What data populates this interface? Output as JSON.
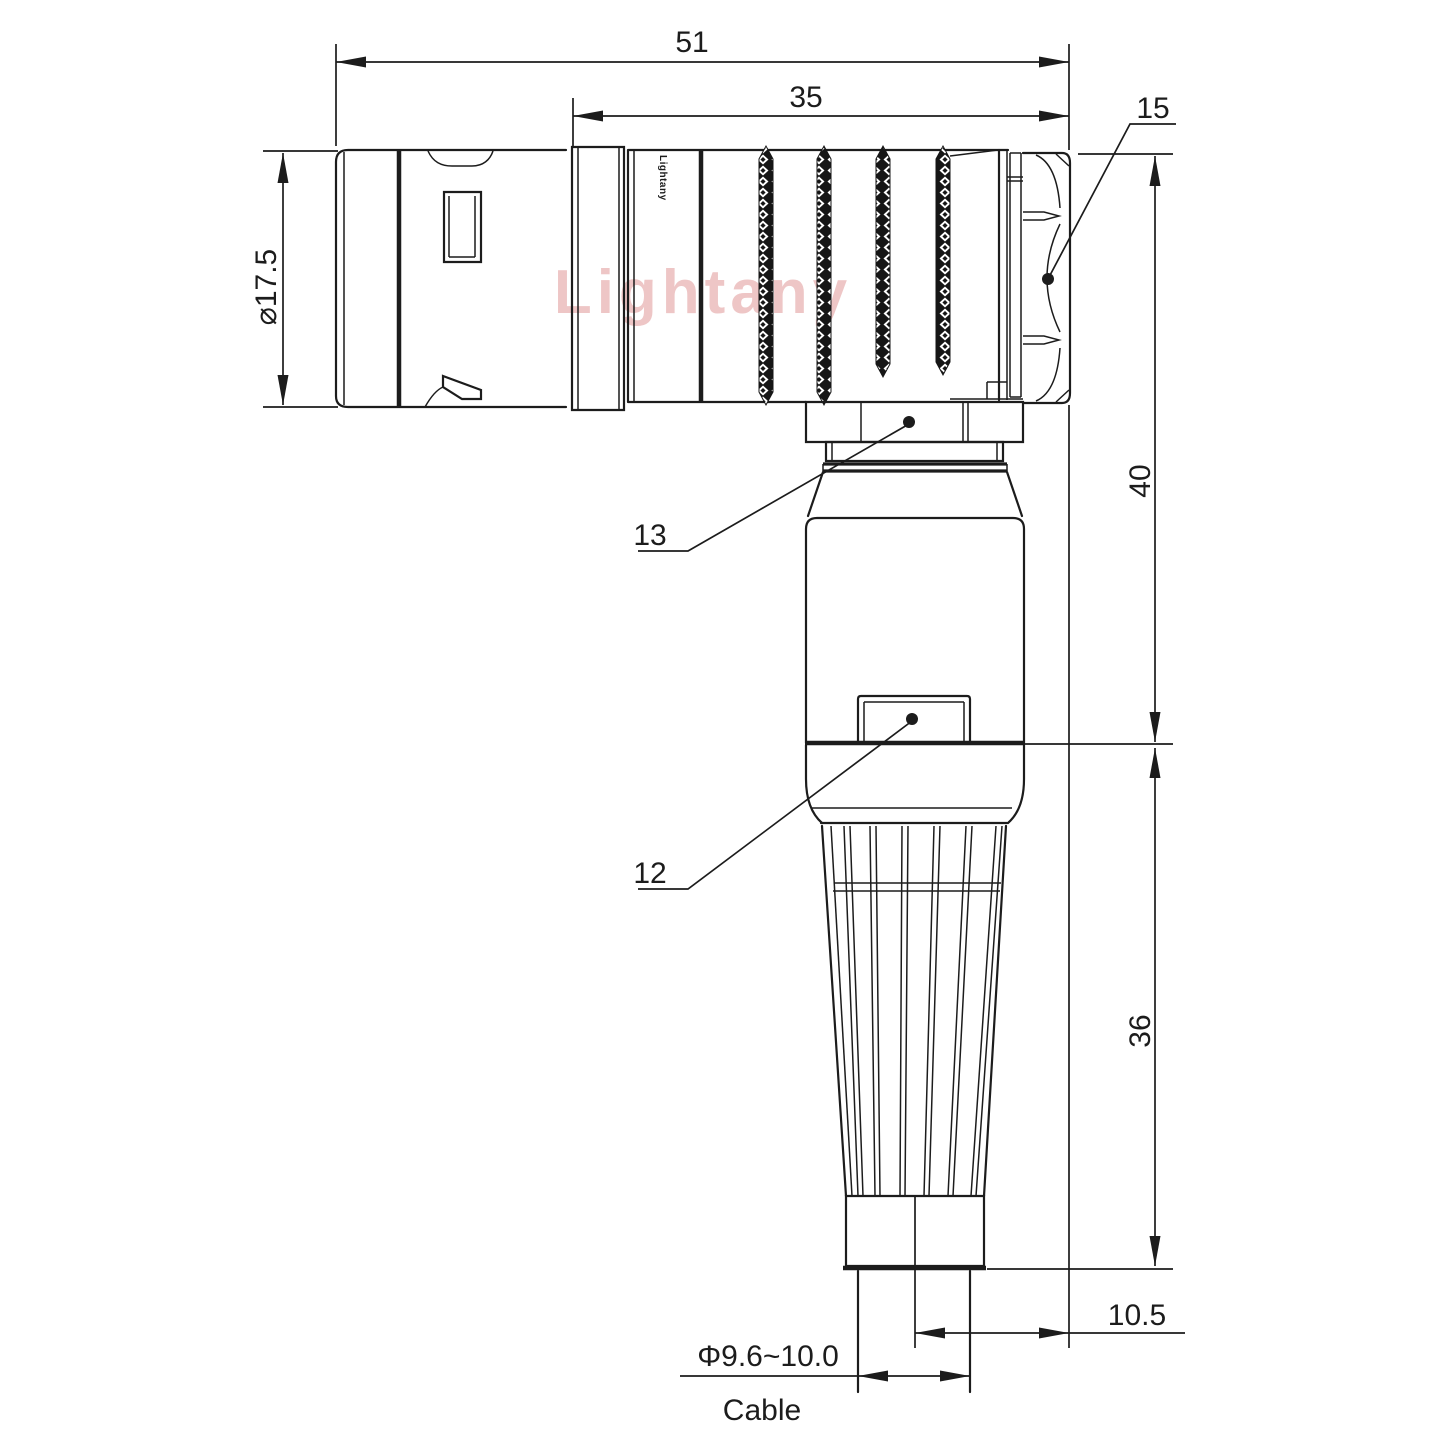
{
  "title": "Right-angle circular connector technical drawing",
  "watermark": "Lightany",
  "brand_marking": "Lightany",
  "dims": {
    "overall_length": "51",
    "body_length": "35",
    "hex_nut_ref": "15",
    "front_diameter": "⌀17.5",
    "upper_height": "40",
    "lower_height": "36",
    "cable_axis_offset": "10.5",
    "cable_diameter": "Φ9.6~10.0",
    "cable_label": "Cable",
    "ref_13": "13",
    "ref_12": "12"
  },
  "colors": {
    "line": "#1c1c1c",
    "watermark": "#eec6c6",
    "background": "#ffffff"
  }
}
